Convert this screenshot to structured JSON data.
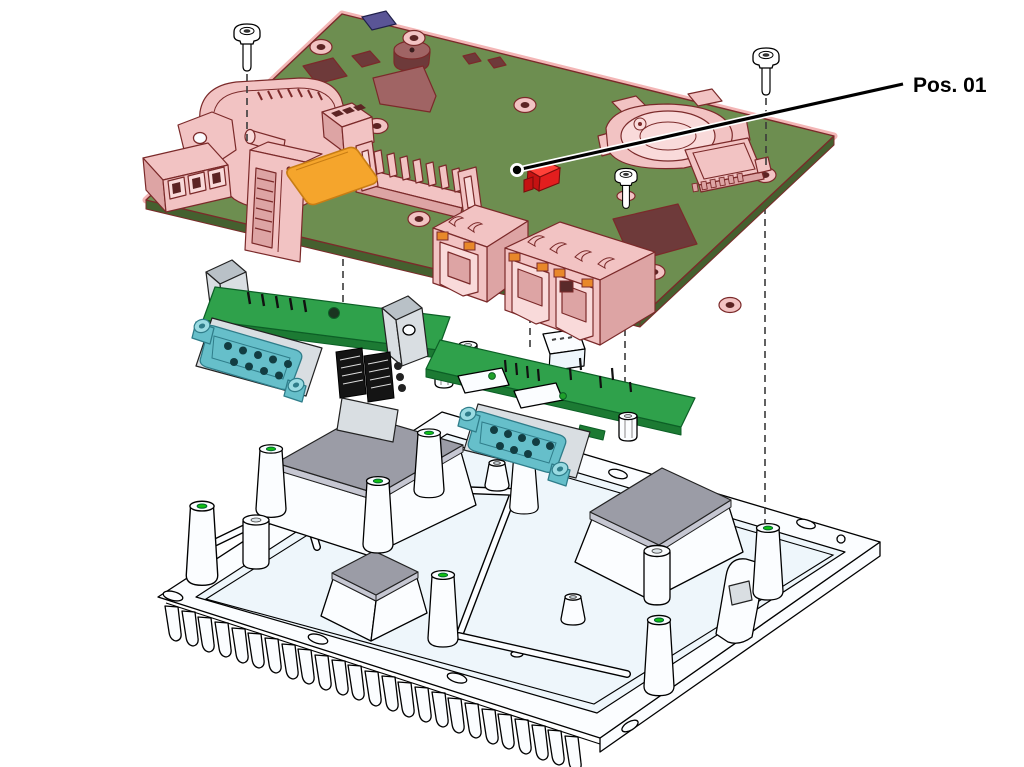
{
  "callout": {
    "label": "Pos. 01",
    "target_part": "main-board"
  },
  "diagram": {
    "type": "exploded-assembly-drawing",
    "parts": [
      "main-board",
      "mounting-screw-left",
      "mounting-screw-right",
      "board-screw",
      "power-terminal-block",
      "usb-connector-block",
      "pin-header",
      "status-led",
      "coin-cell-holder",
      "micro-sd-slot",
      "ethernet-port-single",
      "ethernet-port-double",
      "serial-adapter-board-left",
      "serial-adapter-board-right",
      "d-sub-9-connector",
      "board-to-board-connector",
      "heatsink-chassis",
      "thermal-pad",
      "mounting-post",
      "alignment-line"
    ]
  },
  "colors": {
    "board_green": "#6d8e50",
    "board_green_edge": "#45602f",
    "highlight_pink": "#f2c3c3",
    "highlight_pink_dark": "#dda4a4",
    "highlight_pink_light": "#f9dada",
    "highlight_outline": "#7b2a2a",
    "halo_pink": "#f3b6b6",
    "component_maroon": "#6e3a3a",
    "component_maroon_light": "#a06464",
    "purple_chip": "#5a5596",
    "orange_pad": "#f5a52c",
    "orange_dark": "#c87d14",
    "led_red": "#e31e1e",
    "led_orange": "#e8882a",
    "adapter_green": "#2fa14b",
    "adapter_green_dark": "#1c7a33",
    "dsub_teal": "#66bfca",
    "dsub_teal_dark": "#2f7d8a",
    "dsub_teal_light": "#9adbe2",
    "metal_gray": "#d9dee2",
    "metal_gray_dark": "#b9c1c7",
    "chassis_white": "#fbfdff",
    "chassis_tint": "#eef6fb",
    "thermal_pad_gray": "#9b9ca6",
    "thermal_pad_gray_light": "#c6c7d2",
    "hole_green": "#12c012"
  }
}
